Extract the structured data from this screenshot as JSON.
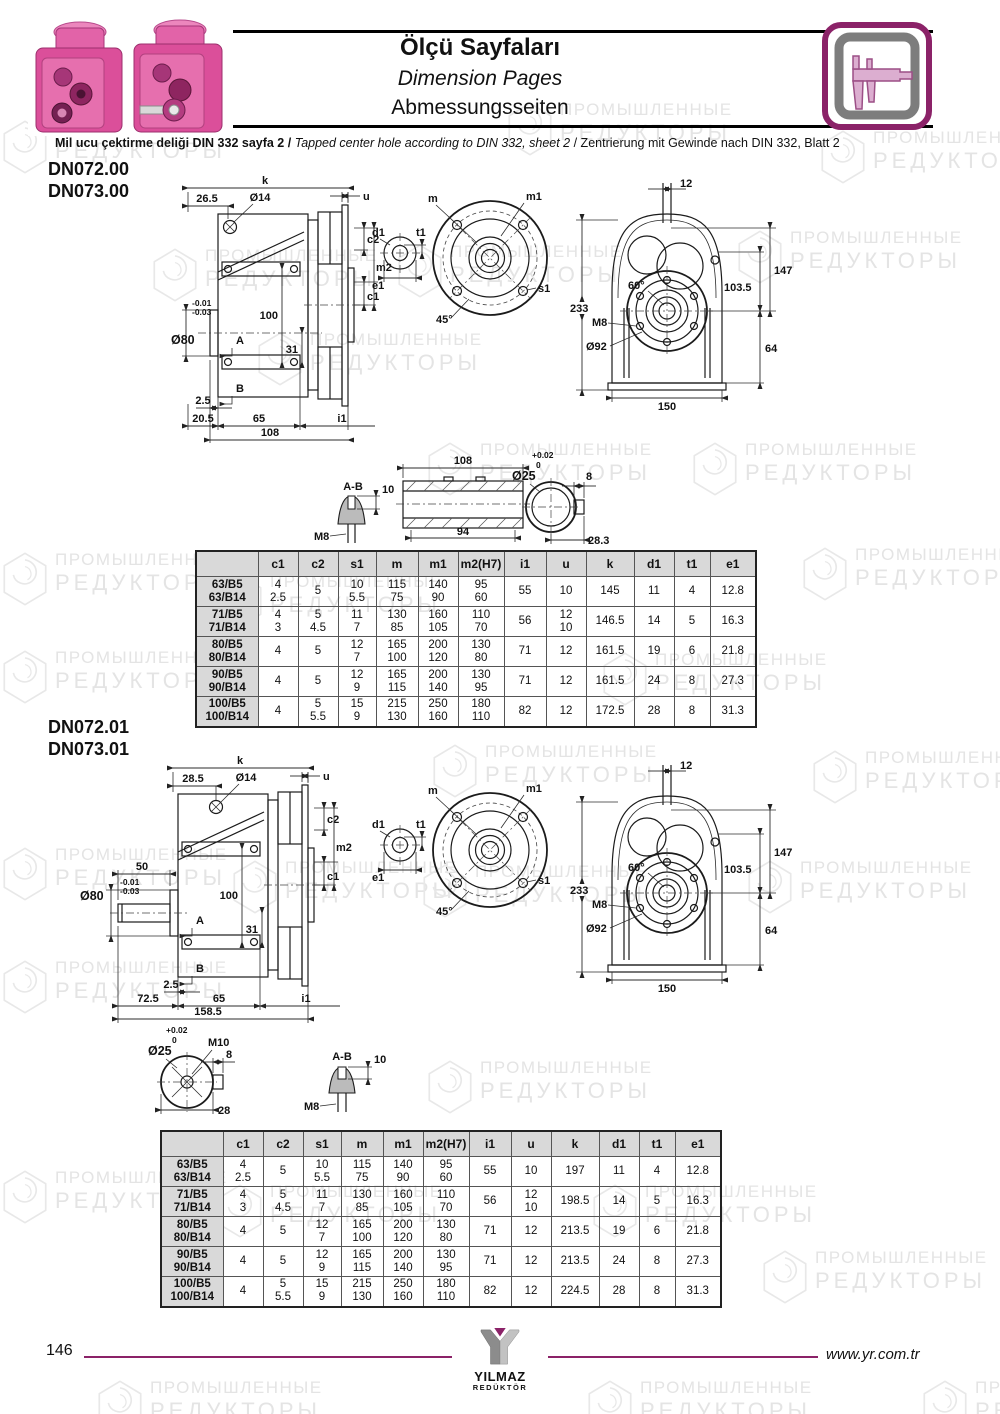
{
  "header": {
    "title_tr": "Ölçü Sayfaları",
    "title_en": "Dimension Pages",
    "title_de": "Abmessungsseiten"
  },
  "note": {
    "tr": "Mil ucu çektirme deliği DIN 332 sayfa 2 /",
    "en": "Tapped center hole according to DIN 332, sheet 2",
    "de": "/  Zentrierung mit Gewinde nach DIN 332, Blatt 2"
  },
  "watermark": {
    "line1": "ПРОМЫШЛЕННЫЕ",
    "line2": "РЕДУКТОРЫ"
  },
  "colors": {
    "accent": "#8b2268",
    "pink": "#db4f9a",
    "table_header_bg": "#d9d9d9"
  },
  "section1": {
    "model1": "DN072.00",
    "model2": "DN073.00"
  },
  "section2": {
    "model1": "DN072.01",
    "model2": "DN073.01"
  },
  "drawings": {
    "side1": {
      "k": "k",
      "off": "26.5",
      "dia14": "Ø14",
      "u": "u",
      "c2": "c2",
      "m2": "m2",
      "c1": "c1",
      "h100": "100",
      "tolu": "-0.01",
      "toll": "-0.03",
      "dia80": "Ø80",
      "A": "A",
      "d31": "31",
      "B": "B",
      "d2_5": "2.5",
      "d20_5": "20.5",
      "d65": "65",
      "i1": "i1",
      "d108": "108"
    },
    "side2": {
      "k": "k",
      "off": "28.5",
      "dia14": "Ø14",
      "u": "u",
      "c2": "c2",
      "m2": "m2",
      "c1": "c1",
      "d50": "50",
      "h100": "100",
      "tolu": "-0.01",
      "toll": "-0.03",
      "dia80": "Ø80",
      "A": "A",
      "d31": "31",
      "B": "B",
      "d2_5": "2.5",
      "d72_5": "72.5",
      "d65": "65",
      "i1": "i1",
      "d158_5": "158.5"
    },
    "flange": {
      "m": "m",
      "m1": "m1",
      "d1": "d1",
      "t1": "t1",
      "e1": "e1",
      "s1": "s1",
      "deg45": "45°"
    },
    "front": {
      "d12": "12",
      "d233": "233",
      "d147": "147",
      "d103_5": "103.5",
      "d64": "64",
      "deg60": "60°",
      "m8": "M8",
      "dia92": "Ø92",
      "d150": "150"
    },
    "shaft1": {
      "ab": "A-B",
      "d10": "10",
      "m8": "M8",
      "d108": "108",
      "d94": "94",
      "tolu": "+0.02",
      "toll": "0",
      "dia25": "Ø25",
      "d8": "8",
      "d28_3": "28.3"
    },
    "shaft2": {
      "tolu": "+0.02",
      "toll": "0",
      "dia25": "Ø25",
      "m10": "M10",
      "d8": "8",
      "d28": "28",
      "ab": "A-B",
      "d10": "10",
      "m8": "M8"
    }
  },
  "table1": {
    "headers": [
      "",
      "c1",
      "c2",
      "s1",
      "m",
      "m1",
      "m2(H7)",
      "i1",
      "u",
      "k",
      "d1",
      "t1",
      "e1"
    ],
    "rows": [
      [
        "63/B5\n63/B14",
        "4\n2.5",
        "5",
        "10\n5.5",
        "115\n75",
        "140\n90",
        "95\n60",
        "55",
        "10",
        "145",
        "11",
        "4",
        "12.8"
      ],
      [
        "71/B5\n71/B14",
        "4\n3",
        "5\n4.5",
        "11\n7",
        "130\n85",
        "160\n105",
        "110\n70",
        "56",
        "12\n10",
        "146.5",
        "14",
        "5",
        "16.3"
      ],
      [
        "80/B5\n80/B14",
        "4",
        "5",
        "12\n7",
        "165\n100",
        "200\n120",
        "130\n80",
        "71",
        "12",
        "161.5",
        "19",
        "6",
        "21.8"
      ],
      [
        "90/B5\n90/B14",
        "4",
        "5",
        "12\n9",
        "165\n115",
        "200\n140",
        "130\n95",
        "71",
        "12",
        "161.5",
        "24",
        "8",
        "27.3"
      ],
      [
        "100/B5\n100/B14",
        "4",
        "5\n5.5",
        "15\n9",
        "215\n130",
        "250\n160",
        "180\n110",
        "82",
        "12",
        "172.5",
        "28",
        "8",
        "31.3"
      ]
    ]
  },
  "table2": {
    "headers": [
      "",
      "c1",
      "c2",
      "s1",
      "m",
      "m1",
      "m2(H7)",
      "i1",
      "u",
      "k",
      "d1",
      "t1",
      "e1"
    ],
    "rows": [
      [
        "63/B5\n63/B14",
        "4\n2.5",
        "5",
        "10\n5.5",
        "115\n75",
        "140\n90",
        "95\n60",
        "55",
        "10",
        "197",
        "11",
        "4",
        "12.8"
      ],
      [
        "71/B5\n71/B14",
        "4\n3",
        "5\n4.5",
        "11\n7",
        "130\n85",
        "160\n105",
        "110\n70",
        "56",
        "12\n10",
        "198.5",
        "14",
        "5",
        "16.3"
      ],
      [
        "80/B5\n80/B14",
        "4",
        "5",
        "12\n7",
        "165\n100",
        "200\n120",
        "130\n80",
        "71",
        "12",
        "213.5",
        "19",
        "6",
        "21.8"
      ],
      [
        "90/B5\n90/B14",
        "4",
        "5",
        "12\n9",
        "165\n115",
        "200\n140",
        "130\n95",
        "71",
        "12",
        "213.5",
        "24",
        "8",
        "27.3"
      ],
      [
        "100/B5\n100/B14",
        "4",
        "5\n5.5",
        "15\n9",
        "215\n130",
        "250\n160",
        "180\n110",
        "82",
        "12",
        "224.5",
        "28",
        "8",
        "31.3"
      ]
    ]
  },
  "footer": {
    "page_number": "146",
    "logo_line1": "YILMAZ",
    "logo_line2": "REDÜKTÖR",
    "website": "www.yr.com.tr"
  }
}
